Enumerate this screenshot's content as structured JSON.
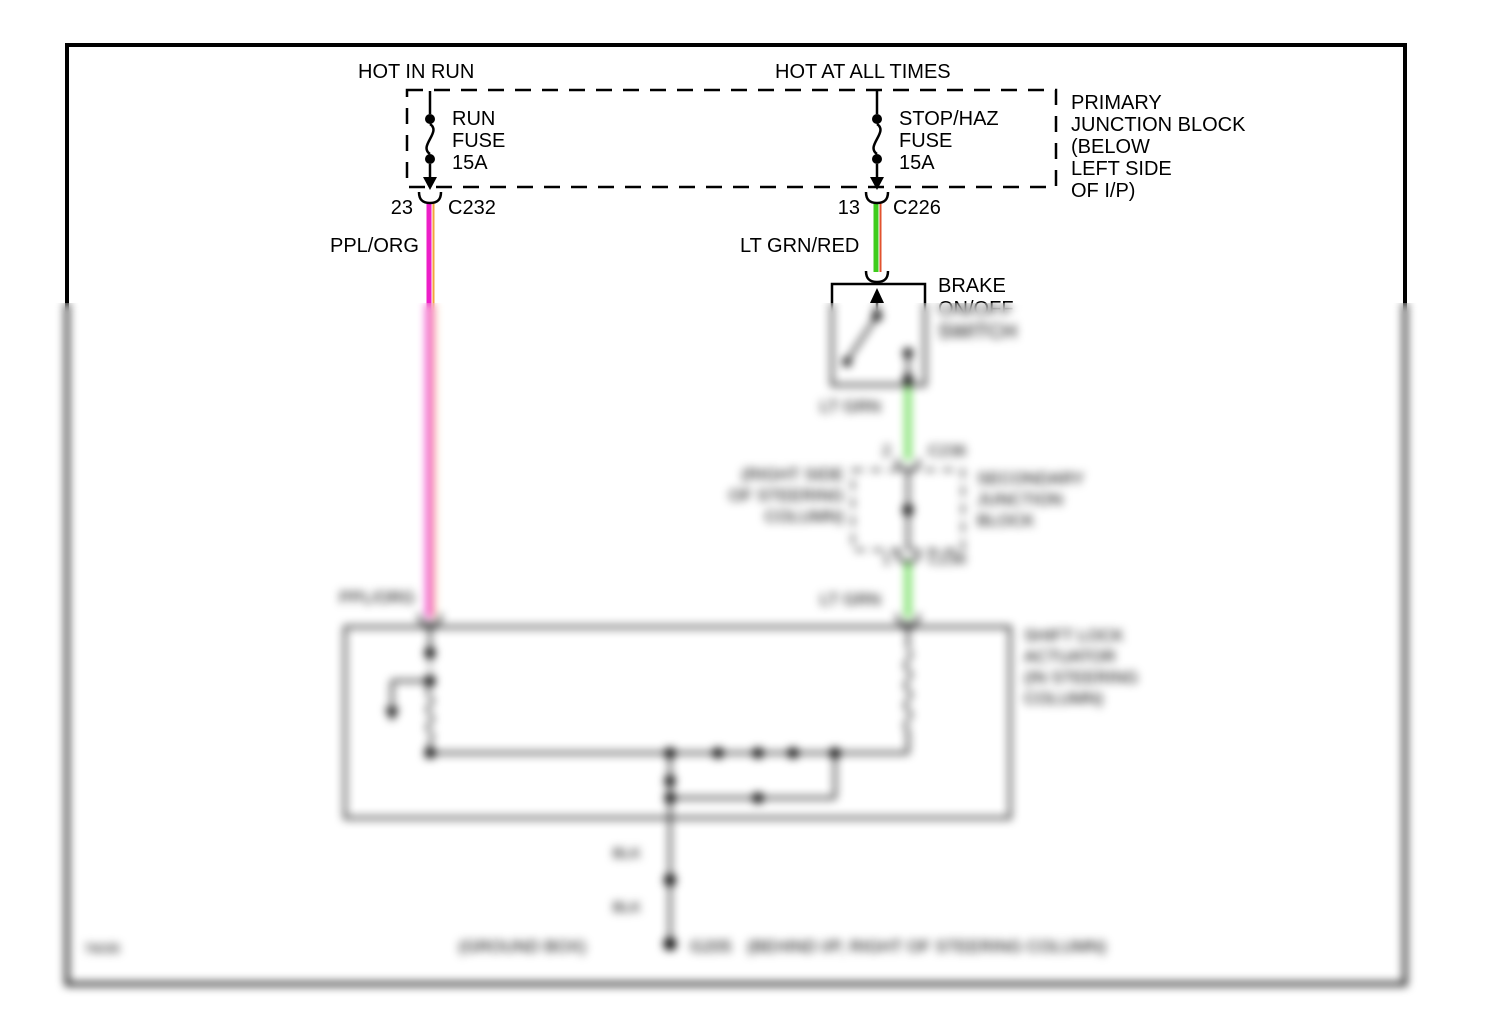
{
  "page": {
    "diagram_id": "76035"
  },
  "power_labels": {
    "hot_in_run": "HOT IN RUN",
    "hot_at_all_times": "HOT AT ALL TIMES"
  },
  "primary_junction_block": {
    "label": "PRIMARY\nJUNCTION BLOCK\n(BELOW\nLEFT SIDE\nOF I/P)",
    "run_fuse": {
      "name": "RUN\nFUSE\n15A",
      "pin": "23",
      "connector": "C232",
      "wire": "PPL/ORG"
    },
    "stop_haz_fuse": {
      "name": "STOP/HAZ\nFUSE\n15A",
      "pin": "13",
      "connector": "C226",
      "wire": "LT GRN/RED"
    }
  },
  "brake_switch": {
    "label": "BRAKE\nON/OFF\nSWITCH",
    "wire_out": "LT GRN"
  },
  "secondary_junction_block": {
    "location": "(RIGHT SIDE\nOF STEERING\nCOLUMN)",
    "name": "SECONDARY\nJUNCTION\nBLOCK",
    "pin_in": "2",
    "connector_in": "C236",
    "pin_out": "1",
    "connector_out": "C236",
    "wire_out": "LT GRN"
  },
  "shift_lock_actuator": {
    "label": "SHIFT LOCK\nACTUATOR\n(IN STEERING\nCOLUMN)",
    "wire_in_left": "PPL/ORG"
  },
  "ground_path": {
    "wire_1": "BLK",
    "wire_2": "BLK",
    "box_label": "(GROUND BOX)",
    "ground_id": "G205",
    "location": "(BEHIND I/P,  RIGHT OF STEERING COLUMN)"
  },
  "colors": {
    "wire_ppl": "#ED1EC7",
    "wire_org": "#F5A33C",
    "wire_ltgrn": "#3ECC1C",
    "wire_red": "#E2522E",
    "wire_ltgrn_plain": "#4ED636",
    "line": "#000000"
  }
}
